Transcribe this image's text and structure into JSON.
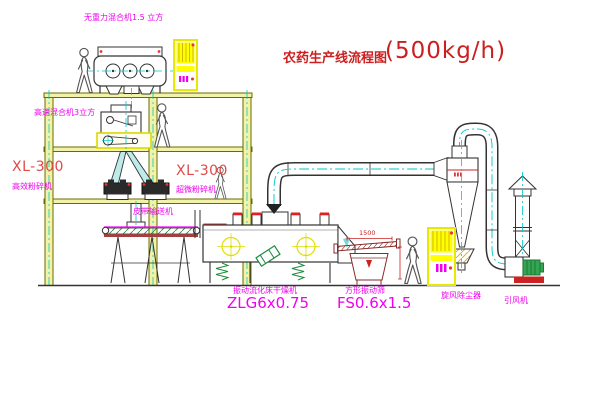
{
  "title": {
    "main": "农药生产线流程图",
    "capacity": "(500kg/h)"
  },
  "equipment_labels": {
    "gravity_free_mixer": "无重力混合机1.5 立方",
    "high_speed_mixer": "高速混合机3立方",
    "pulverizer_left_model": "XL-300",
    "pulverizer_left_name": "高效粉碎机",
    "pulverizer_right_model": "XL-300",
    "pulverizer_right_name": "超微粉碎机",
    "belt_conveyor": "皮带输送机",
    "fluid_bed_dryer_name": "振动流化床干燥机",
    "fluid_bed_dryer_model": "ZLG6x0.75",
    "vibrating_screen_name": "方形振动筛",
    "vibrating_screen_model": "FS0.6x1.5",
    "cyclone_dust_collector": "旋风除尘器",
    "induced_draft_fan": "引风机"
  },
  "dimensions": {
    "screen_length": "1500"
  },
  "colors": {
    "structure_olive": "#6b6b00",
    "label_magenta": "#f000f0",
    "title_red": "#cc2020",
    "centerline_cyan": "#00c8c8",
    "cabinet_yellow": "#ffff00",
    "motor_green": "#35a552",
    "dim_red": "#cc2222"
  }
}
